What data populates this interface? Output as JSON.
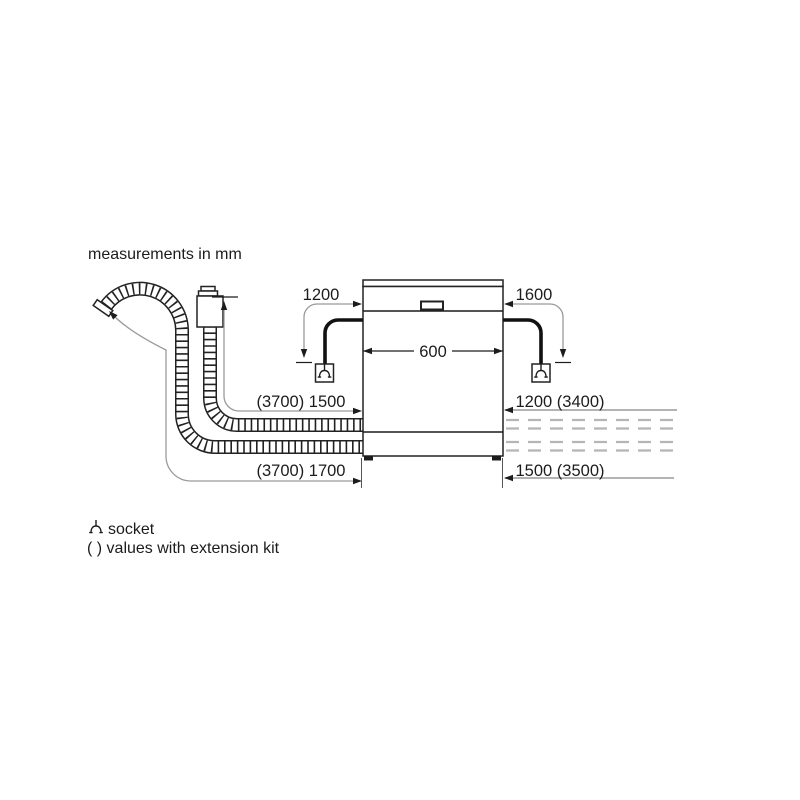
{
  "header": {
    "title": "measurements in mm"
  },
  "dims": {
    "left_cable": "1200",
    "right_cable": "1600",
    "appliance_width": "600",
    "supply_hose": "(3700) 1500",
    "drain_hose": "(3700) 1700",
    "right_supply": "1200 (3400)",
    "right_drain": "1500 (3500)"
  },
  "legend": {
    "socket_icon": "socket-icon",
    "socket_label": "socket",
    "extension_note": "( ) values with extension kit"
  },
  "icons": {
    "socket": "socket-icon"
  },
  "colors": {
    "background": "#ffffff",
    "line": "#1c1c1c",
    "dim_line": "#9a9a9a",
    "dashed_line": "#b5b5b5"
  }
}
